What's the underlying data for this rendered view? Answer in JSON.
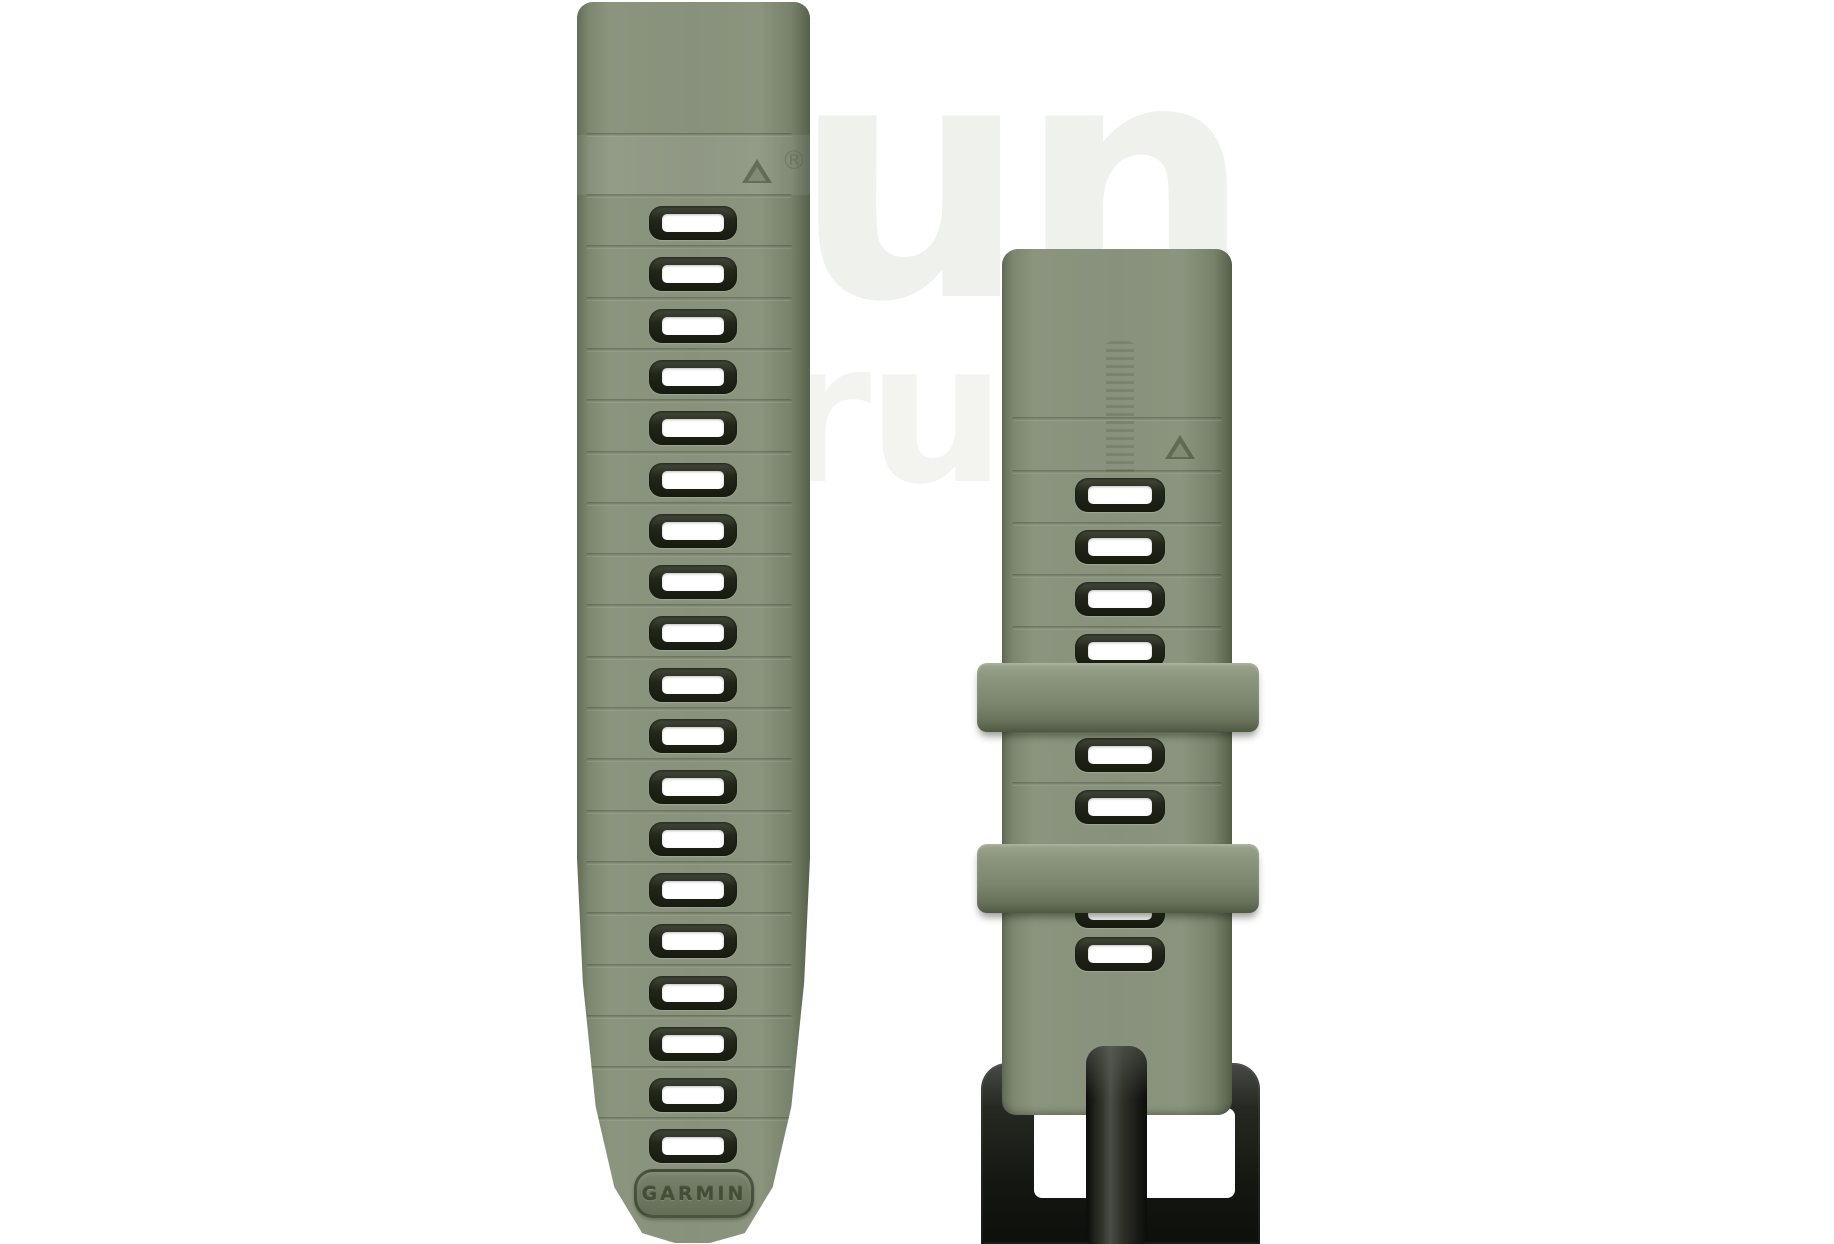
{
  "scene": {
    "type": "product-photo",
    "subject": "Two-piece Garmin QuickFit silicone watch band, moss green with slate holes and black buckle, on white background"
  },
  "left_strap": {
    "slot_count": 19,
    "badge_text": "GARMIN"
  },
  "right_strap": {
    "visible_slot_count": 8,
    "keeper_count": 2,
    "has_buckle": true
  },
  "watermark": {
    "text_large": "run",
    "text_partial": "ru",
    "registered_mark": "®"
  },
  "colors": {
    "background": "#ffffff",
    "strap_green": "#87917b",
    "strap_green_light": "#9aa48b",
    "strap_green_dark": "#57614a",
    "slot_frame": "#20241b",
    "slot_hole": "#ffffff",
    "buckle_black": "#151712",
    "badge_text_color": "#444d36",
    "watermark_gray": "#eff1ec"
  }
}
